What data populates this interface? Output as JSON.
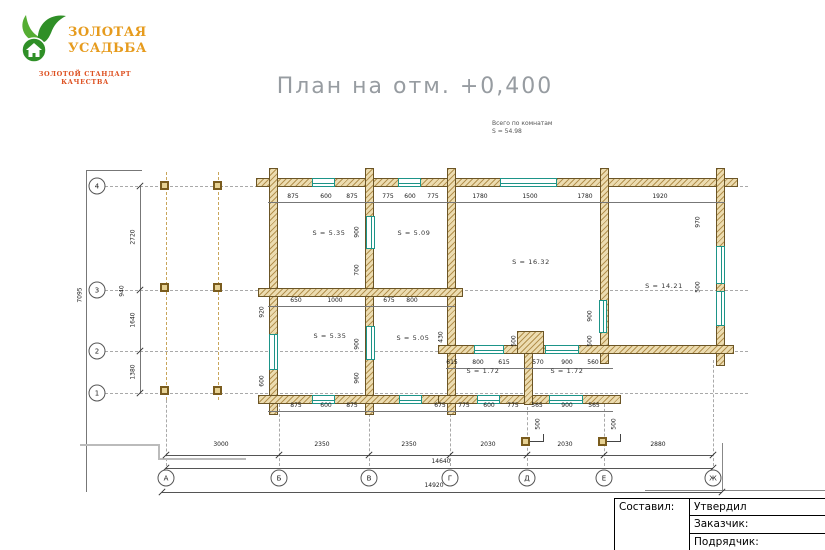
{
  "logo": {
    "brand_line1": "ЗОЛОТАЯ",
    "brand_line2": "УСАДЬБА",
    "tagline": "ЗОЛОТОЙ СТАНДАРТ КАЧЕСТВА"
  },
  "title": "План на отм. +0,400",
  "note": {
    "line1": "Всего по комнатам",
    "line2": "S  =  54.98"
  },
  "titleblock": {
    "composed": "Составил:",
    "approved": "Утвердил",
    "customer": "Заказчик:",
    "contractor": "Подрядчик:"
  },
  "colors": {
    "wall_hatch": "#b3914f",
    "wall_fill": "#ecdcb0",
    "window_teal": "#1d9488",
    "brand_orange": "#e69b1d",
    "tagline_red": "#dd4f1f",
    "title_gray": "#979ca1"
  },
  "plan": {
    "walls": [
      [
        256,
        178,
        482,
        9
      ],
      [
        269,
        168,
        9,
        247
      ],
      [
        365,
        168,
        9,
        247
      ],
      [
        447,
        168,
        9,
        247
      ],
      [
        600,
        168,
        9,
        196
      ],
      [
        716,
        168,
        9,
        198
      ],
      [
        258,
        288,
        205,
        9
      ],
      [
        438,
        345,
        296,
        9
      ],
      [
        258,
        395,
        205,
        9
      ],
      [
        438,
        395,
        183,
        9
      ],
      [
        524,
        339,
        9,
        66
      ],
      [
        517,
        331,
        27,
        23
      ]
    ],
    "windows": [
      [
        312,
        178,
        23,
        9,
        "h"
      ],
      [
        398,
        178,
        23,
        9,
        "h"
      ],
      [
        500,
        178,
        57,
        9,
        "h"
      ],
      [
        312,
        395,
        23,
        9,
        "h"
      ],
      [
        399,
        395,
        23,
        9,
        "h"
      ],
      [
        474,
        345,
        30,
        9,
        "h"
      ],
      [
        545,
        345,
        34,
        9,
        "h"
      ],
      [
        477,
        395,
        23,
        9,
        "h"
      ],
      [
        549,
        395,
        34,
        9,
        "h"
      ],
      [
        269,
        334,
        9,
        36,
        "v"
      ],
      [
        716,
        246,
        9,
        38,
        "v"
      ],
      [
        716,
        291,
        9,
        35,
        "v"
      ],
      [
        599,
        300,
        8,
        33,
        "v"
      ],
      [
        366,
        216,
        9,
        33,
        "v"
      ],
      [
        366,
        326,
        9,
        34,
        "v"
      ]
    ],
    "columns": [
      [
        160,
        181
      ],
      [
        213,
        181
      ],
      [
        160,
        283
      ],
      [
        213,
        283
      ],
      [
        160,
        386
      ],
      [
        213,
        386
      ],
      [
        521,
        437
      ],
      [
        598,
        437
      ]
    ],
    "dash_h": [
      [
        186,
        90,
        748
      ],
      [
        290,
        90,
        748
      ],
      [
        351,
        90,
        748
      ],
      [
        393,
        90,
        748
      ]
    ],
    "dash_v": [
      [
        166,
        172,
        400,
        "tan"
      ],
      [
        218,
        172,
        400,
        "tan"
      ],
      [
        166,
        400,
        466,
        "gray"
      ],
      [
        279,
        404,
        466,
        "gray"
      ],
      [
        369,
        404,
        466,
        "gray"
      ],
      [
        450,
        404,
        466,
        "gray"
      ],
      [
        527,
        356,
        466,
        "gray"
      ],
      [
        604,
        404,
        466,
        "gray"
      ],
      [
        713,
        360,
        466,
        "gray"
      ]
    ],
    "lines": [
      [
        268,
        202,
        457,
        1,
        "#777"
      ],
      [
        268,
        306,
        187,
        1,
        "#777"
      ],
      [
        446,
        368,
        167,
        1,
        "#777"
      ],
      [
        268,
        411,
        345,
        1,
        "#777"
      ],
      [
        166,
        455,
        547,
        1,
        "#555"
      ],
      [
        166,
        468,
        547,
        1,
        "#555"
      ],
      [
        162,
        492,
        560,
        1,
        "#555"
      ],
      [
        140,
        186,
        1,
        207,
        "#777"
      ],
      [
        86,
        170,
        1,
        322,
        "#777"
      ],
      [
        86,
        170,
        56,
        1,
        "#777"
      ],
      [
        722,
        443,
        1,
        47,
        "#888"
      ],
      [
        645,
        490,
        180,
        1,
        "#888"
      ],
      [
        80,
        444,
        80,
        2,
        "#bbbbbb"
      ],
      [
        158,
        444,
        2,
        16,
        "#bbbbbb"
      ],
      [
        158,
        458,
        88,
        2,
        "#bbbbbb"
      ],
      [
        530,
        441,
        14,
        1,
        "#444"
      ],
      [
        543,
        434,
        1,
        8,
        "#444"
      ],
      [
        607,
        441,
        14,
        1,
        "#444"
      ],
      [
        620,
        434,
        1,
        8,
        "#444"
      ]
    ],
    "ticks": [
      [
        166,
        455
      ],
      [
        279,
        455
      ],
      [
        369,
        455
      ],
      [
        450,
        455
      ],
      [
        527,
        455
      ],
      [
        604,
        455
      ],
      [
        713,
        455
      ],
      [
        166,
        468
      ],
      [
        713,
        468
      ],
      [
        162,
        492
      ],
      [
        722,
        492
      ],
      [
        140,
        186
      ],
      [
        140,
        290
      ],
      [
        140,
        351
      ],
      [
        140,
        393
      ]
    ],
    "dims_h": [
      [
        221,
        448,
        "3000"
      ],
      [
        322,
        448,
        "2350"
      ],
      [
        409,
        448,
        "2350"
      ],
      [
        488,
        448,
        "2030"
      ],
      [
        565,
        448,
        "2030"
      ],
      [
        658,
        448,
        "2880"
      ],
      [
        441,
        465,
        "14640"
      ],
      [
        434,
        489,
        "14920"
      ],
      [
        293,
        200,
        "875"
      ],
      [
        326,
        200,
        "600"
      ],
      [
        352,
        200,
        "875"
      ],
      [
        388,
        200,
        "775"
      ],
      [
        410,
        200,
        "600"
      ],
      [
        433,
        200,
        "775"
      ],
      [
        480,
        200,
        "1780"
      ],
      [
        530,
        200,
        "1500"
      ],
      [
        585,
        200,
        "1780"
      ],
      [
        660,
        200,
        "1920"
      ],
      [
        296,
        304,
        "650"
      ],
      [
        335,
        304,
        "1000"
      ],
      [
        389,
        304,
        "675"
      ],
      [
        412,
        304,
        "800"
      ],
      [
        452,
        366,
        "615"
      ],
      [
        478,
        366,
        "800"
      ],
      [
        504,
        366,
        "615"
      ],
      [
        538,
        366,
        "570"
      ],
      [
        567,
        366,
        "900"
      ],
      [
        593,
        366,
        "560"
      ],
      [
        296,
        409,
        "875"
      ],
      [
        326,
        409,
        "600"
      ],
      [
        352,
        409,
        "875"
      ],
      [
        440,
        409,
        "675"
      ],
      [
        464,
        409,
        "775"
      ],
      [
        489,
        409,
        "600"
      ],
      [
        513,
        409,
        "775"
      ],
      [
        537,
        409,
        "565"
      ],
      [
        567,
        409,
        "900"
      ],
      [
        594,
        409,
        "565"
      ]
    ],
    "dims_v": [
      [
        80,
        295,
        "7095"
      ],
      [
        133,
        237,
        "2720"
      ],
      [
        122,
        291,
        "940"
      ],
      [
        133,
        320,
        "1640"
      ],
      [
        133,
        372,
        "1380"
      ],
      [
        357,
        232,
        "900"
      ],
      [
        357,
        270,
        "700"
      ],
      [
        357,
        344,
        "900"
      ],
      [
        357,
        378,
        "960"
      ],
      [
        262,
        312,
        "920"
      ],
      [
        262,
        381,
        "600"
      ],
      [
        698,
        222,
        "970"
      ],
      [
        698,
        287,
        "500"
      ],
      [
        590,
        316,
        "900"
      ],
      [
        590,
        341,
        "500"
      ],
      [
        441,
        337,
        "430"
      ],
      [
        514,
        341,
        "500"
      ],
      [
        538,
        424,
        "500"
      ],
      [
        614,
        424,
        "500"
      ]
    ],
    "rooms": [
      [
        329,
        233,
        "S  =  5.35"
      ],
      [
        414,
        233,
        "S  =  5.09"
      ],
      [
        531,
        262,
        "S  =  16.32"
      ],
      [
        664,
        286,
        "S  =  14.21"
      ],
      [
        330,
        336,
        "S  =  5.35"
      ],
      [
        413,
        338,
        "S  =  5.05"
      ],
      [
        483,
        371,
        "S  =  1.72"
      ],
      [
        567,
        371,
        "S  =  1.72"
      ]
    ],
    "axes_bottom": {
      "cy": 478,
      "items": [
        [
          "А",
          166
        ],
        [
          "Б",
          279
        ],
        [
          "В",
          369
        ],
        [
          "Г",
          450
        ],
        [
          "Д",
          527
        ],
        [
          "Е",
          604
        ],
        [
          "Ж",
          713
        ]
      ]
    },
    "axes_left": {
      "cx": 97,
      "items": [
        [
          "4",
          186
        ],
        [
          "3",
          290
        ],
        [
          "2",
          351
        ],
        [
          "1",
          393
        ]
      ]
    }
  }
}
